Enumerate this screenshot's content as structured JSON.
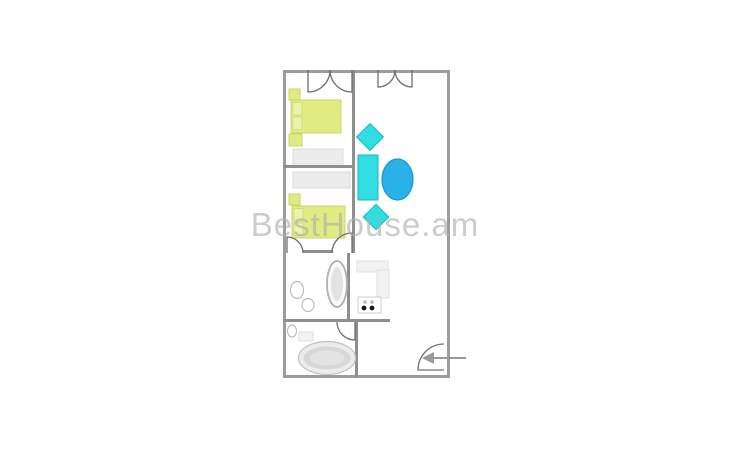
{
  "watermark": {
    "text": "BestHouse.am",
    "color": "#acacac"
  },
  "plan": {
    "width": 167,
    "height": 308,
    "colors": {
      "outer_wall": "#9c9c9c",
      "wall": "#8f8f8f",
      "door": "#6f6f6f",
      "bed_fill": "#e0ec82",
      "bed_stroke": "#c8d868",
      "pillow_fill": "#ecf3ad",
      "pillow_stroke": "#ccd883",
      "cyan_fill": "#30dde0",
      "cyan_stroke": "#14b8c4",
      "blue_fill": "#29b1e8",
      "blue_stroke": "#149ad4",
      "gray_fill": "#ececec",
      "gray_stroke": "#dcdcdc",
      "fixture_stroke": "#bcbcbc",
      "arrow": "#9a9a9a",
      "burner_dark": "#1a1a1a",
      "burner_light": "#b9b9b9"
    },
    "walls": [
      {
        "name": "living-divider-wall",
        "x": 69,
        "y": 0,
        "w": 3,
        "h": 183
      },
      {
        "name": "bedroom-divider-wall",
        "x": 0,
        "y": 95,
        "w": 72,
        "h": 3
      },
      {
        "name": "bedroom2-south-wall",
        "x": 20,
        "y": 180,
        "w": 30,
        "h": 3
      },
      {
        "name": "wc-east-wall",
        "x": 64,
        "y": 183,
        "w": 3,
        "h": 69
      },
      {
        "name": "wc-south-wall",
        "x": 0,
        "y": 249,
        "w": 107,
        "h": 3
      },
      {
        "name": "bathroom-east-wall",
        "x": 72,
        "y": 252,
        "w": 3,
        "h": 56
      }
    ],
    "doors": [
      {
        "name": "bedroom1-balcony-door-left",
        "d": "M25,0 L25,22 A22,22 0 0 0 47,0"
      },
      {
        "name": "bedroom1-balcony-door-right",
        "d": "M69,0 L69,22 A22,22 0 0 1 47,0"
      },
      {
        "name": "living-balcony-door-left",
        "d": "M95,0 L95,17 A17,17 0 0 0 112,0"
      },
      {
        "name": "living-balcony-door-right",
        "d": "M129,0 L129,17 A17,17 0 0 1 112,0"
      },
      {
        "name": "bedroom2-door-left",
        "d": "M4,183 L4,167 A16,16 0 0 1 20,183"
      },
      {
        "name": "bedroom2-door-right",
        "d": "M69,183 L69,163 A20,20 0 0 0 49,183"
      },
      {
        "name": "bathroom-door",
        "d": "M72,252 L72,270 A18,18 0 0 1 54,252"
      },
      {
        "name": "entrance-door",
        "d": "M161,300 L135,300 A26,26 0 0 1 161,274"
      }
    ],
    "entrance_arrow": {
      "tail": "M183,288 L149,288",
      "head": "M139,288 l12,-6 l0,12 z"
    },
    "furniture": [
      {
        "type": "rect",
        "name": "nightstand",
        "x": 6,
        "y": 19,
        "w": 11,
        "h": 11,
        "palette": "bed"
      },
      {
        "type": "bed",
        "name": "bed-double",
        "x": 8,
        "y": 30,
        "w": 50,
        "h": 33
      },
      {
        "type": "rect",
        "name": "nightstand",
        "x": 6,
        "y": 64,
        "w": 13,
        "h": 12,
        "palette": "bed"
      },
      {
        "type": "rect",
        "name": "wardrobe",
        "x": 10,
        "y": 79,
        "w": 50,
        "h": 15,
        "palette": "gray"
      },
      {
        "type": "rect",
        "name": "wardrobe",
        "x": 10,
        "y": 102,
        "w": 57,
        "h": 16,
        "palette": "gray"
      },
      {
        "type": "rect",
        "name": "nightstand",
        "x": 6,
        "y": 124,
        "w": 11,
        "h": 11,
        "palette": "bed"
      },
      {
        "type": "bed",
        "name": "bed-double",
        "x": 9,
        "y": 136,
        "w": 53,
        "h": 32
      },
      {
        "type": "diamond",
        "name": "armchair",
        "cx": 87,
        "cy": 67,
        "s": 19,
        "palette": "cyan"
      },
      {
        "type": "rect",
        "name": "sofa",
        "x": 75,
        "y": 85,
        "w": 20,
        "h": 45,
        "palette": "cyan"
      },
      {
        "type": "ellipse",
        "name": "table",
        "cx": 114.5,
        "cy": 109.5,
        "rx": 15.5,
        "ry": 20.5,
        "palette": "blue"
      },
      {
        "type": "diamond",
        "name": "armchair",
        "cx": 93,
        "cy": 147,
        "s": 18,
        "palette": "cyan"
      },
      {
        "type": "boiler",
        "name": "boiler",
        "cx": 54,
        "cy": 214,
        "rx": 10,
        "ry": 23
      },
      {
        "type": "ellipse",
        "name": "sink",
        "cx": 14,
        "cy": 220,
        "rx": 6.5,
        "ry": 8.5,
        "palette": "outline"
      },
      {
        "type": "ellipse",
        "name": "toilet",
        "cx": 25,
        "cy": 235,
        "rx": 6,
        "ry": 6.5,
        "palette": "outline"
      },
      {
        "type": "rect",
        "name": "kitchen-counter",
        "x": 74,
        "y": 191,
        "w": 31,
        "h": 11,
        "palette": "lightgray"
      },
      {
        "type": "rect",
        "name": "kitchen-counter",
        "x": 94,
        "y": 200,
        "w": 12,
        "h": 28,
        "palette": "lightgray"
      },
      {
        "type": "stove",
        "name": "stove",
        "x": 75,
        "y": 227,
        "w": 23,
        "h": 16
      },
      {
        "type": "ellipse",
        "name": "bath-sink",
        "cx": 9,
        "cy": 261,
        "rx": 4.5,
        "ry": 6,
        "palette": "outline"
      },
      {
        "type": "rect",
        "name": "bath-cabinet",
        "x": 16,
        "y": 262,
        "w": 14,
        "h": 9,
        "palette": "lightgray"
      },
      {
        "type": "tub",
        "name": "bathtub",
        "cx": 44,
        "cy": 288,
        "rx": 28.5,
        "ry": 16.5
      }
    ]
  }
}
